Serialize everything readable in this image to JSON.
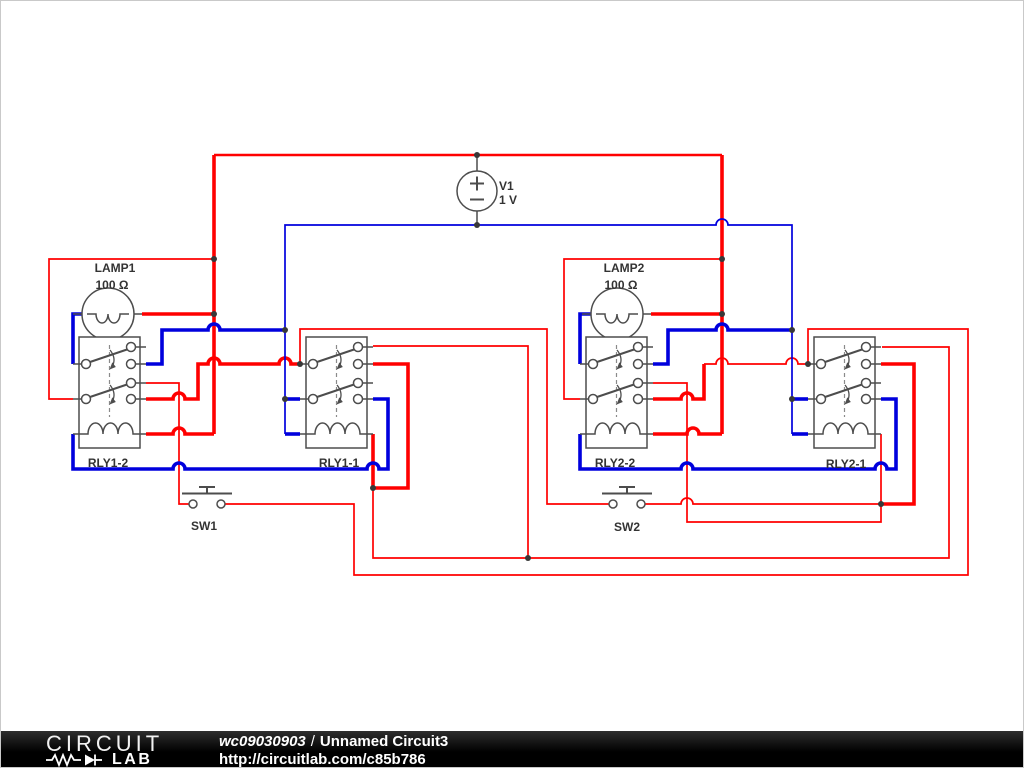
{
  "schematic": {
    "source": {
      "name": "V1",
      "value": "1 V"
    },
    "lamp1": {
      "name": "LAMP1",
      "value": "100 Ω"
    },
    "lamp2": {
      "name": "LAMP2",
      "value": "100 Ω"
    },
    "relay1_2": {
      "name": "RLY1-2"
    },
    "relay1_1": {
      "name": "RLY1-1"
    },
    "relay2_2": {
      "name": "RLY2-2"
    },
    "relay2_1": {
      "name": "RLY2-1"
    },
    "switch1": {
      "name": "SW1"
    },
    "switch2": {
      "name": "SW2"
    },
    "colors": {
      "wire_red": "#ff0000",
      "wire_blue": "#0000dd",
      "component_gray": "#4d4d4d",
      "label": "#333333"
    }
  },
  "footer": {
    "logo_top": "CIRCUIT",
    "logo_bottom": "LAB",
    "workspace_id": "wc09030903",
    "separator": "/",
    "circuit_title": "Unnamed Circuit3",
    "url": "http://circuitlab.com/c85b786",
    "bg": "#000000",
    "text_color": "#ffffff"
  }
}
